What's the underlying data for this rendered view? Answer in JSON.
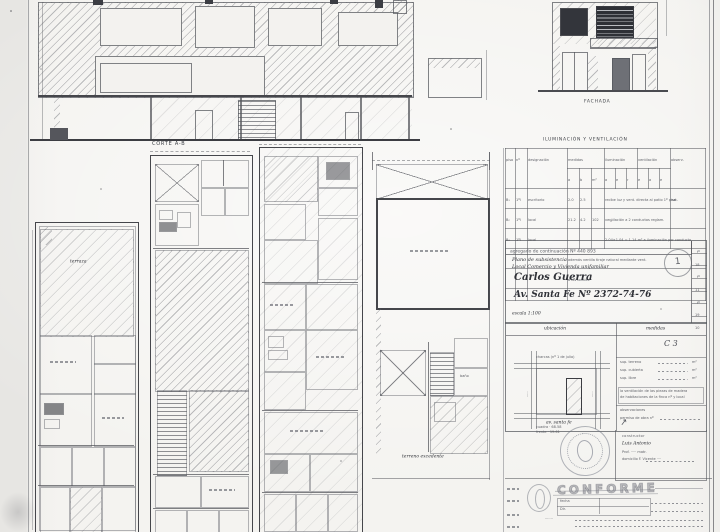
{
  "labels": {
    "corte": "CORTE A-B",
    "fachada": "FACHADA"
  },
  "plans": {
    "terraza": "terraza",
    "bano": "baño",
    "terreno_excedente": "terreno excedente"
  },
  "table": {
    "title": "ILUMINACIÓN Y VENTILACIÓN",
    "head": {
      "c1": "piso",
      "c2": "nº",
      "c3": "designación",
      "g1": "medidas",
      "g2": "iluminación",
      "g3": "ventilación",
      "obs": "observ."
    },
    "sub": [
      "a",
      "b",
      "m²",
      "a",
      "e",
      "r",
      "e",
      "a",
      "e"
    ],
    "rows": [
      [
        "B₁",
        "1ºl",
        "escritorio",
        "2.0",
        "2.5",
        "",
        "recibe luz y vent. directa al patio 1º piso",
        "nat."
      ],
      [
        "B₂",
        "1ºl",
        "local",
        "21.2",
        "4.2",
        "102",
        "ventilación a 2 conductos  reglam.",
        ""
      ],
      [
        "B₃",
        "1ºl",
        "local",
        "",
        "",
        "",
        "2.04×1.04 = 1.14 m²  a iluminación por conducto",
        ""
      ]
    ],
    "notes": [
      "además ventila tiraje natural mediante vent.",
      "a los locales"
    ]
  },
  "titleblock": {
    "header": "agregado de continuación   Nº 440 893",
    "plano": "Plano de subsistencia",
    "tipo": "Local Comercio y Vivienda unifamiliar",
    "owner": "Carlos Guerra",
    "address": "Av. Santa Fe    Nº 2372-74-76",
    "escala": "escala 1:100",
    "stamp": "1",
    "folio": [
      "fº",
      "18",
      "fº",
      "11",
      "fº",
      "19",
      "10"
    ]
  },
  "ubicacion": {
    "title": "ubicación",
    "street_top": "charcas (nº 1 de julio)",
    "street_bottom": "av. santa fe",
    "street_left": "·····",
    "street_right": "·····",
    "dim1": "cuadra · 68.58",
    "dim2": "frente · 19.61"
  },
  "medidas": {
    "title": "medidas",
    "mark": "C 3",
    "r1": "sup. terreno",
    "r2": "sup. cubierta",
    "r3": "sup. libre",
    "unit": "m²",
    "note1": "la ventilación de las piezas de madera",
    "note2": "de habitaciones de la finca nº y local",
    "obs": "observaciones",
    "permiso": "permiso de obra nº"
  },
  "constructor": {
    "title": "constructor",
    "name": "Luis Antonio",
    "line2": "Prof. ····· matr.",
    "line3": "domicilio F. Vicente ····"
  },
  "conforme": {
    "word": "CONFORME",
    "fecha": "fecha",
    "dir": "Dir.",
    "row_label": "·······"
  }
}
